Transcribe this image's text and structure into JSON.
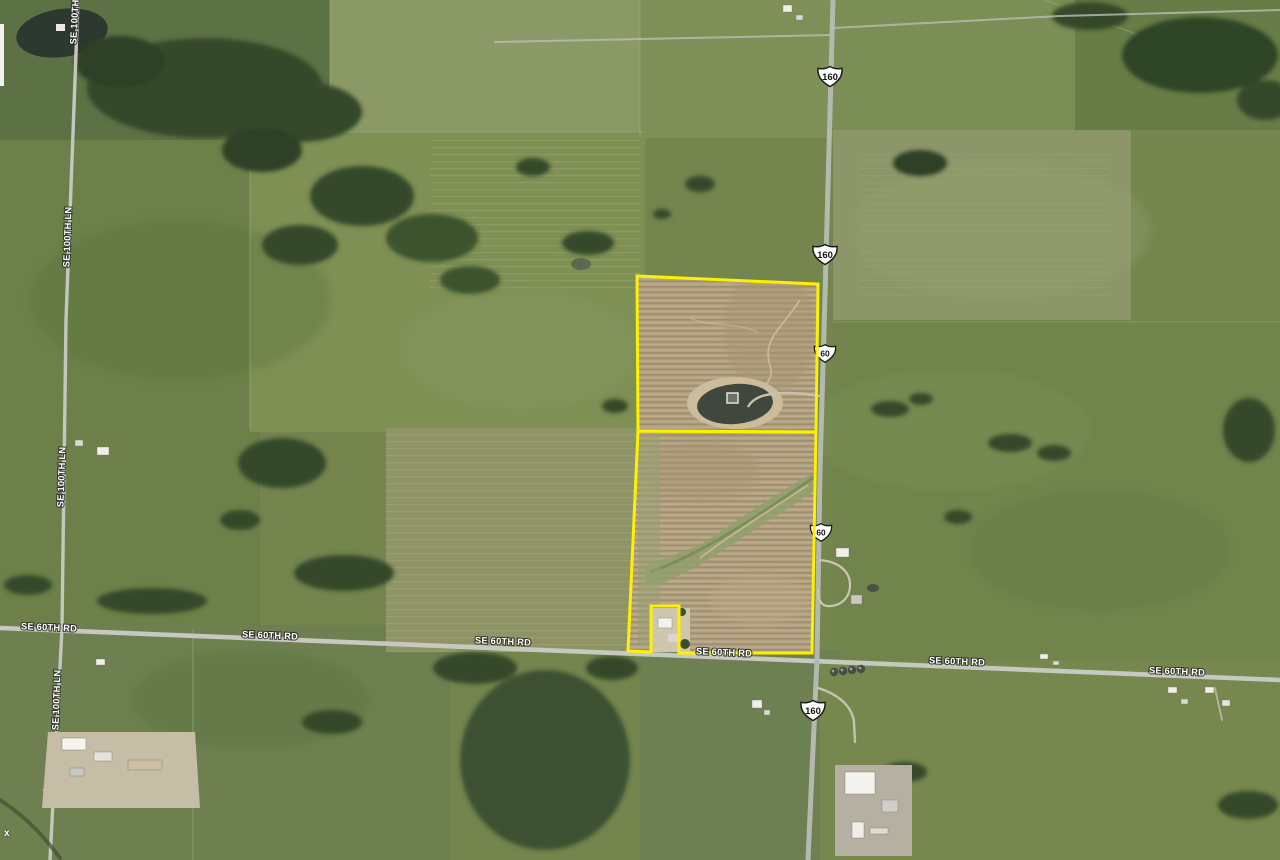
{
  "map": {
    "imagery": "satellite",
    "boundary_color": "#fdf000",
    "watermark": "x",
    "road_labels": [
      {
        "text": "SE 100TH"
      },
      {
        "text": "SE 100TH LN"
      },
      {
        "text": "SE 100TH LN"
      },
      {
        "text": "SE 100TH LN"
      },
      {
        "text": "SE 60TH RD"
      },
      {
        "text": "SE 60TH RD"
      },
      {
        "text": "SE 60TH RD"
      },
      {
        "text": "SE 60TH RD"
      },
      {
        "text": "SE 60TH RD"
      },
      {
        "text": "SE 60TH RD"
      }
    ],
    "highway_shields": [
      {
        "route": "160"
      },
      {
        "route": "160"
      },
      {
        "route": "60"
      },
      {
        "route": "60"
      },
      {
        "route": "160"
      }
    ]
  }
}
